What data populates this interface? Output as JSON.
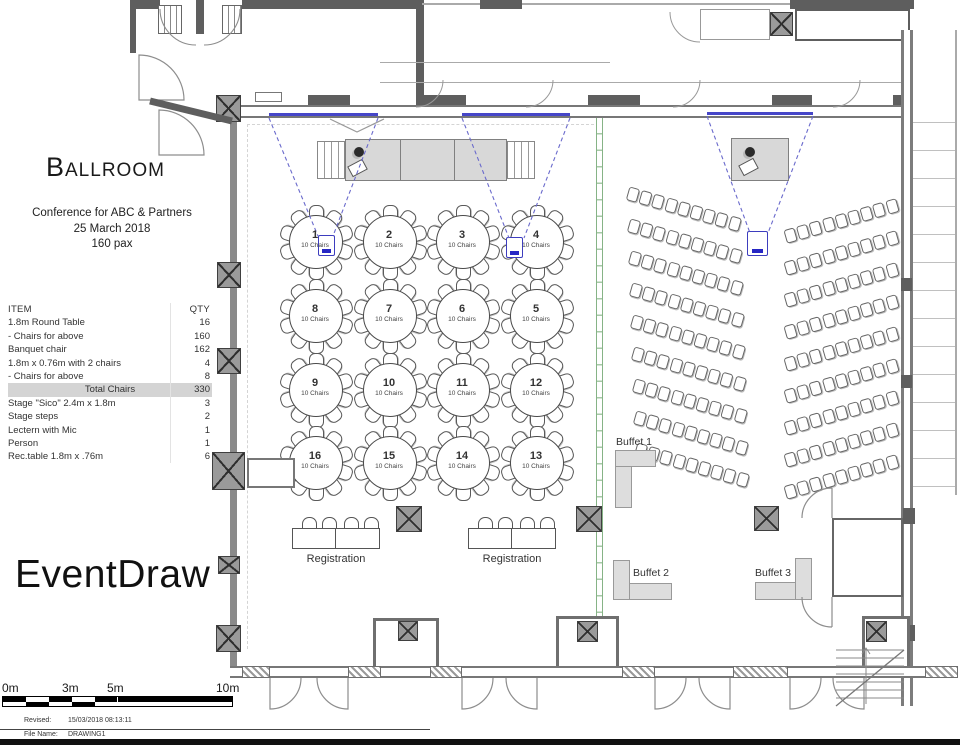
{
  "info_panel": {
    "title": "Ballroom",
    "subtitle_lines": [
      "Conference for ABC & Partners",
      "25 March 2018",
      "160 pax"
    ],
    "items_table": {
      "headers": [
        "ITEM",
        "QTY"
      ],
      "rows": [
        {
          "item": "1.8m Round Table",
          "qty": "16",
          "total": false
        },
        {
          "item": "- Chairs for above",
          "qty": "160",
          "total": false
        },
        {
          "item": "Banquet chair",
          "qty": "162",
          "total": false
        },
        {
          "item": "1.8m x 0.76m with 2 chairs",
          "qty": "4",
          "total": false
        },
        {
          "item": "- Chairs for above",
          "qty": "8",
          "total": false
        },
        {
          "item": "Total Chairs",
          "qty": "330",
          "total": true
        },
        {
          "item": "Stage \"Sico\" 2.4m x 1.8m",
          "qty": "3",
          "total": false
        },
        {
          "item": "Stage steps",
          "qty": "2",
          "total": false
        },
        {
          "item": "Lectern with Mic",
          "qty": "1",
          "total": false
        },
        {
          "item": "Person",
          "qty": "1",
          "total": false
        },
        {
          "item": "Rec.table 1.8m x .76m",
          "qty": "6",
          "total": false
        }
      ]
    },
    "watermark": "EventDraw"
  },
  "floor_plan": {
    "round_tables": {
      "seat_label": "10 Chairs",
      "numbers_in_layout_order": [
        "1",
        "2",
        "3",
        "4",
        "8",
        "7",
        "6",
        "5",
        "9",
        "10",
        "11",
        "12",
        "16",
        "15",
        "14",
        "13"
      ]
    },
    "registration_labels": [
      "Registration",
      "Registration"
    ],
    "buffet_labels": [
      "Buffet 1",
      "Buffet 2",
      "Buffet 3"
    ],
    "theater": {
      "banks": 2,
      "rows_per_bank": 9,
      "chairs_per_row": 9
    },
    "icons": [
      "projector-icon",
      "screen-icon",
      "person-icon",
      "lectern-icon",
      "column-icon",
      "stairs-icon",
      "door-swing-icon"
    ]
  },
  "scale_bar": {
    "labels": [
      "0m",
      "3m",
      "5m",
      "10m"
    ]
  },
  "footer": {
    "revised_label": "Revised:",
    "revised_value": "15/03/2018 08:13:11",
    "file_label": "File Name:",
    "file_value": "DRAWING1"
  },
  "colors": {
    "screen_blue": "#4646c8",
    "projector_blue": "#2626c4",
    "partition_green": "#86b386",
    "wall_gray": "#8a8a8a",
    "stage_fill": "#d8d8d8"
  }
}
